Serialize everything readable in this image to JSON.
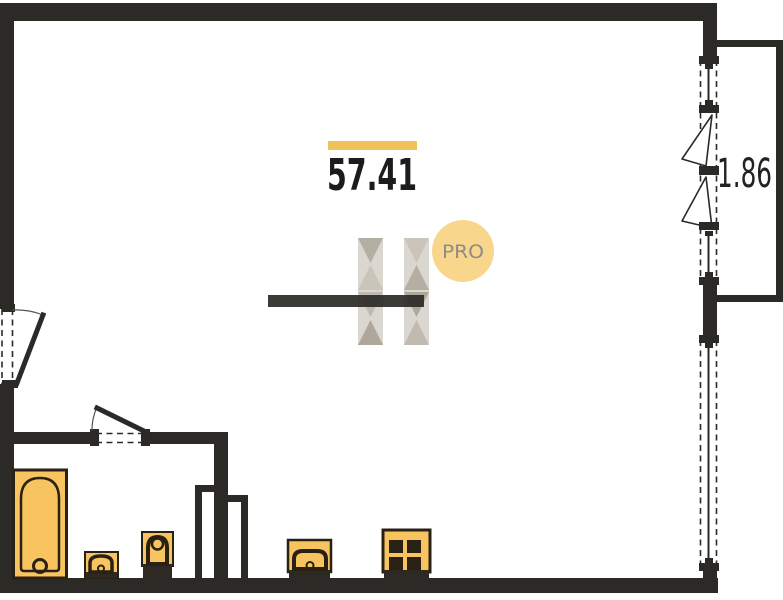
{
  "labels": {
    "main_area": "57.41",
    "balcony_area": "1.86"
  },
  "watermark": {
    "letter": "H",
    "badge": "PRO"
  },
  "fixtures": [
    "bathtub",
    "washbasin",
    "toilet",
    "kitchen-sink",
    "stove"
  ],
  "openings": [
    "entry-door",
    "bathroom-door",
    "balcony-window-sashes",
    "fixed-window"
  ],
  "colors": {
    "wall": "#2b2a27",
    "accent": "#eec159",
    "fixture_fill": "#f7c45f",
    "fixture_line": "#2a2115",
    "fixture_base": "#2e2a23",
    "badge_fill": "#f8d78c",
    "badge_text": "#8f8c87",
    "label_text": "#1c1c1c",
    "logo_light": "#d9d5ce",
    "logo_mid": "#c8c1b8",
    "logo_mid2": "#beb7ad",
    "logo_dark": "#b2aa9f",
    "logo_deep": "#aba396"
  }
}
